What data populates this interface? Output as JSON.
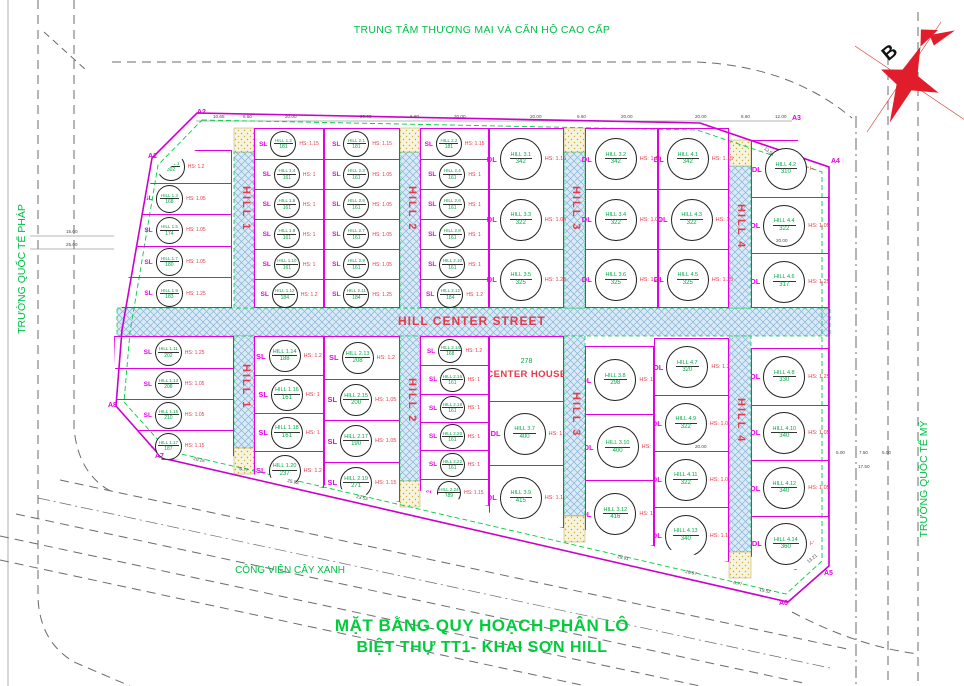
{
  "title": {
    "line1": "MẶT BẰNG QUY HOẠCH PHÂN LÔ",
    "line2": "BIỆT THỰ TT1- KHAI SƠN HILL"
  },
  "surroundings": {
    "top": "TRUNG TÂM THƯƠNG MẠI VÀ CĂN HỘ CAO CẤP",
    "left": "TRƯỜNG QUỐC TẾ PHÁP",
    "right": "TRƯỜNG QUỐC TẾ MỸ",
    "park": "CÔNG VIÊN CÂY XANH"
  },
  "compass": {
    "letter": "B"
  },
  "street": {
    "center_label": "HILL CENTER STREET",
    "names": [
      "HILL 1",
      "HILL 2",
      "HILL 3",
      "HILL 4"
    ]
  },
  "legend_colors": {
    "lot_line": "#e400e4",
    "street_text": "#e8394a",
    "area_text": "#00a844",
    "boundary": "#cc00cc",
    "setback_dash": "#00cc44",
    "street_fill": "#d9eaf8"
  },
  "boundary_markers": [
    {
      "label": "A1"
    },
    {
      "label": "A2"
    },
    {
      "label": "A3"
    },
    {
      "label": "A4"
    },
    {
      "label": "A5"
    },
    {
      "label": "A6"
    },
    {
      "label": "A7"
    },
    {
      "label": "A8"
    }
  ],
  "blocks": [
    {
      "id": "tL",
      "lots": [
        {
          "type": "DL",
          "name": "HILL 1.1",
          "area": "302",
          "hs": "HS: 1.2"
        },
        {
          "type": "SL",
          "name": "HILL 1.3",
          "area": "168",
          "hs": "HS: 1.05"
        },
        {
          "type": "SL",
          "name": "HILL 1.5",
          "area": "174",
          "hs": "HS: 1.05"
        },
        {
          "type": "SL",
          "name": "HILL 1.7",
          "area": "180",
          "hs": "HS: 1.05"
        },
        {
          "type": "SL",
          "name": "HILL 1.9",
          "area": "183",
          "hs": "HS: 1.25"
        }
      ]
    },
    {
      "id": "t12a",
      "lots": [
        {
          "type": "SL",
          "name": "HILL 1.2",
          "area": "181",
          "hs": "HS: 1.15"
        },
        {
          "type": "SL",
          "name": "HILL 1.4",
          "area": "161",
          "hs": "HS: 1"
        },
        {
          "type": "SL",
          "name": "HILL 1.6",
          "area": "161",
          "hs": "HS: 1"
        },
        {
          "type": "SL",
          "name": "HILL 1.8",
          "area": "161",
          "hs": "HS: 1"
        },
        {
          "type": "SL",
          "name": "HILL 1.10",
          "area": "161",
          "hs": "HS: 1"
        },
        {
          "type": "SL",
          "name": "HILL 1.12",
          "area": "184",
          "hs": "HS: 1.2"
        }
      ]
    },
    {
      "id": "t12b",
      "lots": [
        {
          "type": "SL",
          "name": "HILL 2.1",
          "area": "181",
          "hs": "HS: 1.15"
        },
        {
          "type": "SL",
          "name": "HILL 2.3",
          "area": "161",
          "hs": "HS: 1.05"
        },
        {
          "type": "SL",
          "name": "HILL 2.5",
          "area": "161",
          "hs": "HS: 1.05"
        },
        {
          "type": "SL",
          "name": "HILL 2.7",
          "area": "161",
          "hs": "HS: 1.05"
        },
        {
          "type": "SL",
          "name": "HILL 2.9",
          "area": "161",
          "hs": "HS: 1.05"
        },
        {
          "type": "SL",
          "name": "HILL 2.11",
          "area": "184",
          "hs": "HS: 1.25"
        }
      ]
    },
    {
      "id": "t23a",
      "lots": [
        {
          "type": "SL",
          "name": "HILL 2.2",
          "area": "181",
          "hs": "HS: 1.15"
        },
        {
          "type": "SL",
          "name": "HILL 2.4",
          "area": "161",
          "hs": "HS: 1"
        },
        {
          "type": "SL",
          "name": "HILL 2.6",
          "area": "161",
          "hs": "HS: 1"
        },
        {
          "type": "SL",
          "name": "HILL 2.8",
          "area": "161",
          "hs": "HS: 1"
        },
        {
          "type": "SL",
          "name": "HILL 2.10",
          "area": "161",
          "hs": "HS: 1"
        },
        {
          "type": "SL",
          "name": "HILL 2.12",
          "area": "184",
          "hs": "HS: 1.2"
        }
      ]
    },
    {
      "id": "t23b",
      "lots": [
        {
          "type": "DL",
          "name": "HILL 3.1",
          "area": "342",
          "hs": "HS: 1.15"
        },
        {
          "type": "DL",
          "name": "HILL 3.3",
          "area": "322",
          "hs": "HS: 1.05"
        },
        {
          "type": "DL",
          "name": "HILL 3.5",
          "area": "325",
          "hs": "HS: 1.25"
        }
      ]
    },
    {
      "id": "t34a",
      "lots": [
        {
          "type": "DL",
          "name": "HILL 3.2",
          "area": "342",
          "hs": "HS: 1.15"
        },
        {
          "type": "DL",
          "name": "HILL 3.4",
          "area": "322",
          "hs": "HS: 1.05"
        },
        {
          "type": "DL",
          "name": "HILL 3.6",
          "area": "325",
          "hs": "HS: 1.25"
        }
      ]
    },
    {
      "id": "t34b",
      "lots": [
        {
          "type": "DL",
          "name": "HILL 4.1",
          "area": "342",
          "hs": "HS: 1.15"
        },
        {
          "type": "DL",
          "name": "HILL 4.3",
          "area": "322",
          "hs": "HS: 1"
        },
        {
          "type": "DL",
          "name": "HILL 4.5",
          "area": "325",
          "hs": "HS: 1.25"
        }
      ]
    },
    {
      "id": "tR",
      "lots": [
        {
          "type": "DL",
          "name": "HILL 4.2",
          "area": "310",
          "hs": "HS: 1.2"
        },
        {
          "type": "DL",
          "name": "HILL 4.4",
          "area": "322",
          "hs": "HS: 1.05"
        },
        {
          "type": "DL",
          "name": "HILL 4.6",
          "area": "317",
          "hs": "HS: 1.25"
        }
      ]
    },
    {
      "id": "bL",
      "lots": [
        {
          "type": "SL",
          "name": "HILL 1.11",
          "area": "202",
          "hs": "HS: 1.25"
        },
        {
          "type": "SL",
          "name": "HILL 1.13",
          "area": "208",
          "hs": "HS: 1.05"
        },
        {
          "type": "SL",
          "name": "HILL 1.15",
          "area": "210",
          "hs": "HS: 1.05"
        },
        {
          "type": "SL",
          "name": "HILL 1.17",
          "area": "187",
          "hs": "HS: 1.15"
        }
      ]
    },
    {
      "id": "b12a",
      "lots": [
        {
          "type": "SL",
          "name": "HILL 1.14",
          "area": "188",
          "hs": "HS: 1.2"
        },
        {
          "type": "SL",
          "name": "HILL 1.16",
          "area": "161",
          "hs": "HS: 1"
        },
        {
          "type": "SL",
          "name": "HILL 1.18",
          "area": "161",
          "hs": "HS: 1"
        },
        {
          "type": "SL",
          "name": "HILL 1.20",
          "area": "237",
          "hs": "HS: 1.2"
        }
      ]
    },
    {
      "id": "b12b",
      "lots": [
        {
          "type": "SL",
          "name": "HILL 2.13",
          "area": "208",
          "hs": "HS: 1.2"
        },
        {
          "type": "SL",
          "name": "HILL 2.15",
          "area": "200",
          "hs": "HS: 1.05"
        },
        {
          "type": "SL",
          "name": "HILL 2.17",
          "area": "190",
          "hs": "HS: 1.05"
        },
        {
          "type": "SL",
          "name": "HILL 2.19",
          "area": "271",
          "hs": "HS: 1.15"
        }
      ]
    },
    {
      "id": "b23a",
      "lots": [
        {
          "type": "SL",
          "name": "HILL 2.14",
          "area": "168",
          "hs": "HS: 1.2"
        },
        {
          "type": "SL",
          "name": "HILL 2.16",
          "area": "161",
          "hs": "HS: 1"
        },
        {
          "type": "SL",
          "name": "HILL 2.18",
          "area": "161",
          "hs": "HS: 1"
        },
        {
          "type": "SL",
          "name": "HILL 2.20",
          "area": "161",
          "hs": "HS: 1"
        },
        {
          "type": "SL",
          "name": "HILL 2.22",
          "area": "161",
          "hs": "HS: 1"
        },
        {
          "type": "SL",
          "name": "HILL 2.24",
          "area": "189",
          "hs": "HS: 1.15"
        }
      ]
    },
    {
      "id": "b23b",
      "lots": [
        {
          "type": "CH",
          "name": "CENTER HOUSE",
          "area": "278",
          "hs": ""
        },
        {
          "type": "DL",
          "name": "HILL 3.7",
          "area": "400",
          "hs": "HS: 1"
        },
        {
          "type": "DL",
          "name": "HILL 3.9",
          "area": "415",
          "hs": "HS: 1.15"
        }
      ]
    },
    {
      "id": "b34a",
      "lots": [
        {
          "type": "DL",
          "name": "HILL 3.8",
          "area": "298",
          "hs": "HS: 1.2"
        },
        {
          "type": "DL",
          "name": "HILL 3.10",
          "area": "400",
          "hs": "HS: 1"
        },
        {
          "type": "DL",
          "name": "HILL 3.12",
          "area": "416",
          "hs": "HS: 1.2"
        }
      ]
    },
    {
      "id": "b34b",
      "lots": [
        {
          "type": "DL",
          "name": "HILL 4.7",
          "area": "320",
          "hs": "HS: 1.2"
        },
        {
          "type": "DL",
          "name": "HILL 4.9",
          "area": "322",
          "hs": "HS: 1.05"
        },
        {
          "type": "DL",
          "name": "HILL 4.11",
          "area": "322",
          "hs": "HS: 1.05"
        },
        {
          "type": "DL",
          "name": "HILL 4.13",
          "area": "340",
          "hs": "HS: 1.15"
        }
      ]
    },
    {
      "id": "bR",
      "lots": [
        {
          "type": "DL",
          "name": "HILL 4.8",
          "area": "330",
          "hs": "HS: 1.25"
        },
        {
          "type": "DL",
          "name": "HILL 4.10",
          "area": "340",
          "hs": "HS: 1.05"
        },
        {
          "type": "DL",
          "name": "HILL 4.12",
          "area": "340",
          "hs": "HS: 1.05"
        },
        {
          "type": "DL",
          "name": "HILL 4.14",
          "area": "360",
          "hs": "HS: 1.2"
        }
      ]
    }
  ],
  "dimensions": [
    "10.65",
    "6.60",
    "20.00",
    "20.00",
    "6.60",
    "20.00",
    "20.00",
    "6.60",
    "20.00",
    "20.00",
    "6.60",
    "12.00",
    "13.51",
    "15.00",
    "25.00",
    "5.00",
    "7.50",
    "5.00",
    "17.50",
    "20.00",
    "20.00",
    "6.77",
    "29.91",
    "20.97",
    "6.77",
    "19.52",
    "20.18",
    "25.93",
    "23.53",
    "13.21"
  ]
}
